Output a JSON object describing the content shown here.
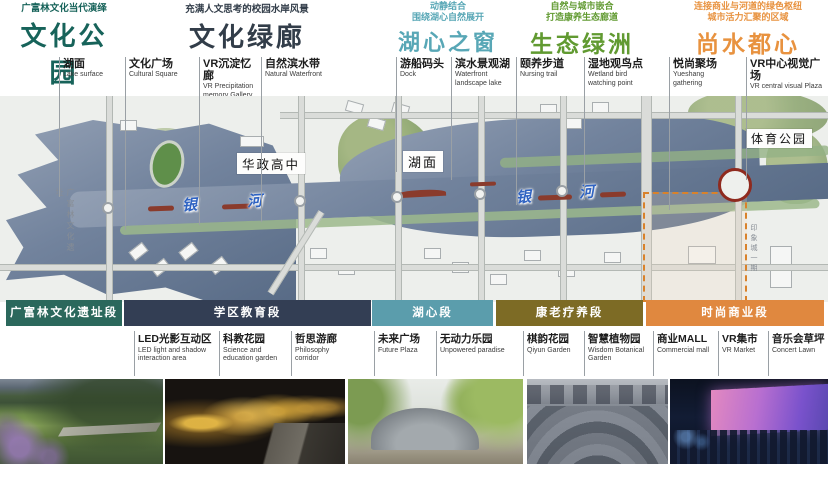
{
  "sections": [
    {
      "title": "文化公园",
      "subtitle": [
        "广富林文化当代演绎"
      ],
      "color": "#17635a",
      "bar": {
        "label": "广富林文化遗址段",
        "color": "#2b685c"
      }
    },
    {
      "title": "文化绿廊",
      "subtitle": [
        "充满人文思考的校园水岸风景"
      ],
      "color": "#323d49",
      "bar": {
        "label": "学区教育段",
        "color": "#333e54"
      }
    },
    {
      "title": "湖心之窗",
      "subtitle": [
        "动静结合",
        "围绕湖心自然展开"
      ],
      "color": "#58a7b6",
      "bar": {
        "label": "湖心段",
        "color": "#5b9dac"
      }
    },
    {
      "title": "生态绿洲",
      "subtitle": [
        "自然与城市嵌合",
        "打造康养生态廊道"
      ],
      "color": "#619a31",
      "bar": {
        "label": "康老疗养段",
        "color": "#7d6b25"
      }
    },
    {
      "title": "尚水都心",
      "subtitle": [
        "连接商业与河道的绿色枢纽",
        "城市活力汇聚的区域"
      ],
      "color": "#e8923f",
      "bar": {
        "label": "时尚商业段",
        "color": "#e0883f"
      }
    }
  ],
  "top_labels": [
    {
      "zh": "湖面",
      "en": "Lake surface"
    },
    {
      "zh": "文化广场",
      "en": "Cultural Square"
    },
    {
      "zh": "VR沉淀忆廊",
      "en": "VR Precipitation memory Gallery"
    },
    {
      "zh": "自然滨水带",
      "en": "Natural Waterfront"
    },
    {
      "zh": "游船码头",
      "en": "Dock"
    },
    {
      "zh": "滨水景观湖",
      "en": "Waterfront landscape lake"
    },
    {
      "zh": "颐养步道",
      "en": "Nursing trail"
    },
    {
      "zh": "湿地观鸟点",
      "en": "Wetland bird watching point"
    },
    {
      "zh": "悦尚聚场",
      "en": "Yueshang gathering"
    },
    {
      "zh": "VR中心视觉广场",
      "en": "VR central visual Plaza"
    }
  ],
  "bottom_labels": [
    {
      "zh": "LED光影互动区",
      "en": "LED light and shadow interaction area"
    },
    {
      "zh": "科教花园",
      "en": "Science and education garden"
    },
    {
      "zh": "哲思游廊",
      "en": "Philosophy corridor"
    },
    {
      "zh": "未来广场",
      "en": "Future Plaza"
    },
    {
      "zh": "无动力乐园",
      "en": "Unpowered paradise"
    },
    {
      "zh": "棋韵花园",
      "en": "Qiyun Garden"
    },
    {
      "zh": "智慧植物园",
      "en": "Wisdom Botanical Garden"
    },
    {
      "zh": "商业MALL",
      "en": "Commercial mall"
    },
    {
      "zh": "VR集市",
      "en": "VR Market"
    },
    {
      "zh": "音乐会草坪",
      "en": "Concert Lawn"
    }
  ],
  "map": {
    "place_labels": [
      "华政高中",
      "湖面",
      "体育公园"
    ],
    "river_chars": [
      "银",
      "河"
    ],
    "vertical_labels": [
      "广富林文化遗址",
      "印象城一期"
    ],
    "water_color": "#5d6f88",
    "boundary_color": "#d9822b",
    "roundabout_color": "#8f2a1e"
  },
  "photos": [
    "park-lawn-photo",
    "light-projection-night-photo",
    "stone-mound-pavilion-photo",
    "slate-amphitheater-photo",
    "night-screen-event-photo"
  ]
}
